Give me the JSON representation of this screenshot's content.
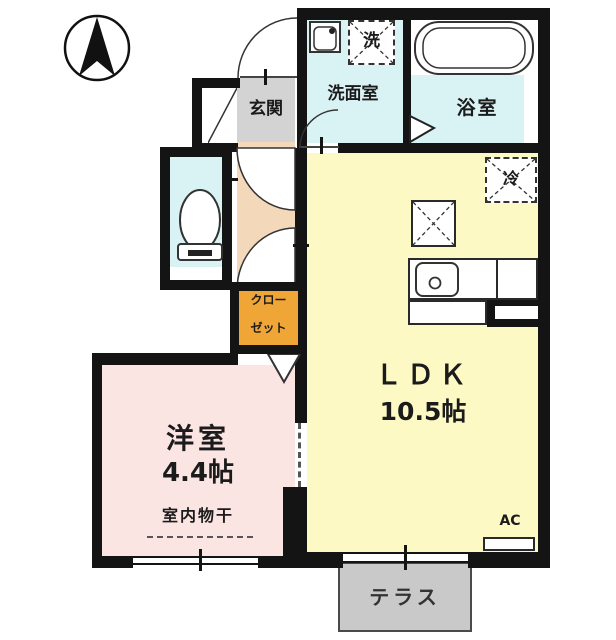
{
  "floorplan": {
    "compass_direction": "north",
    "rooms": {
      "genkan": {
        "label": "玄関"
      },
      "senmenshitsu": {
        "label": "洗面室"
      },
      "laundry": {
        "label": "洗"
      },
      "yokushitsu": {
        "label": "浴室"
      },
      "refrigerator": {
        "label": "冷"
      },
      "closet": {
        "line1": "クロー",
        "line2": "ゼット"
      },
      "ldk": {
        "label": "ＬＤＫ",
        "size": "10.5帖"
      },
      "youshitsu": {
        "label": "洋室",
        "size": "4.4帖",
        "note": "室内物干"
      },
      "ac": {
        "label": "AC"
      },
      "terrace": {
        "label": "テラス"
      }
    },
    "colors": {
      "wall": "#141414",
      "wet_area_floor": "#d9f2f4",
      "genkan_floor": "#d3d3d3",
      "hallway_floor": "#f3d8b9",
      "closet_fill": "#f0a636",
      "ldk_floor": "#fcf9c4",
      "bedroom_floor": "#fbe5e3",
      "terrace_fill": "#c9c9c9"
    }
  }
}
